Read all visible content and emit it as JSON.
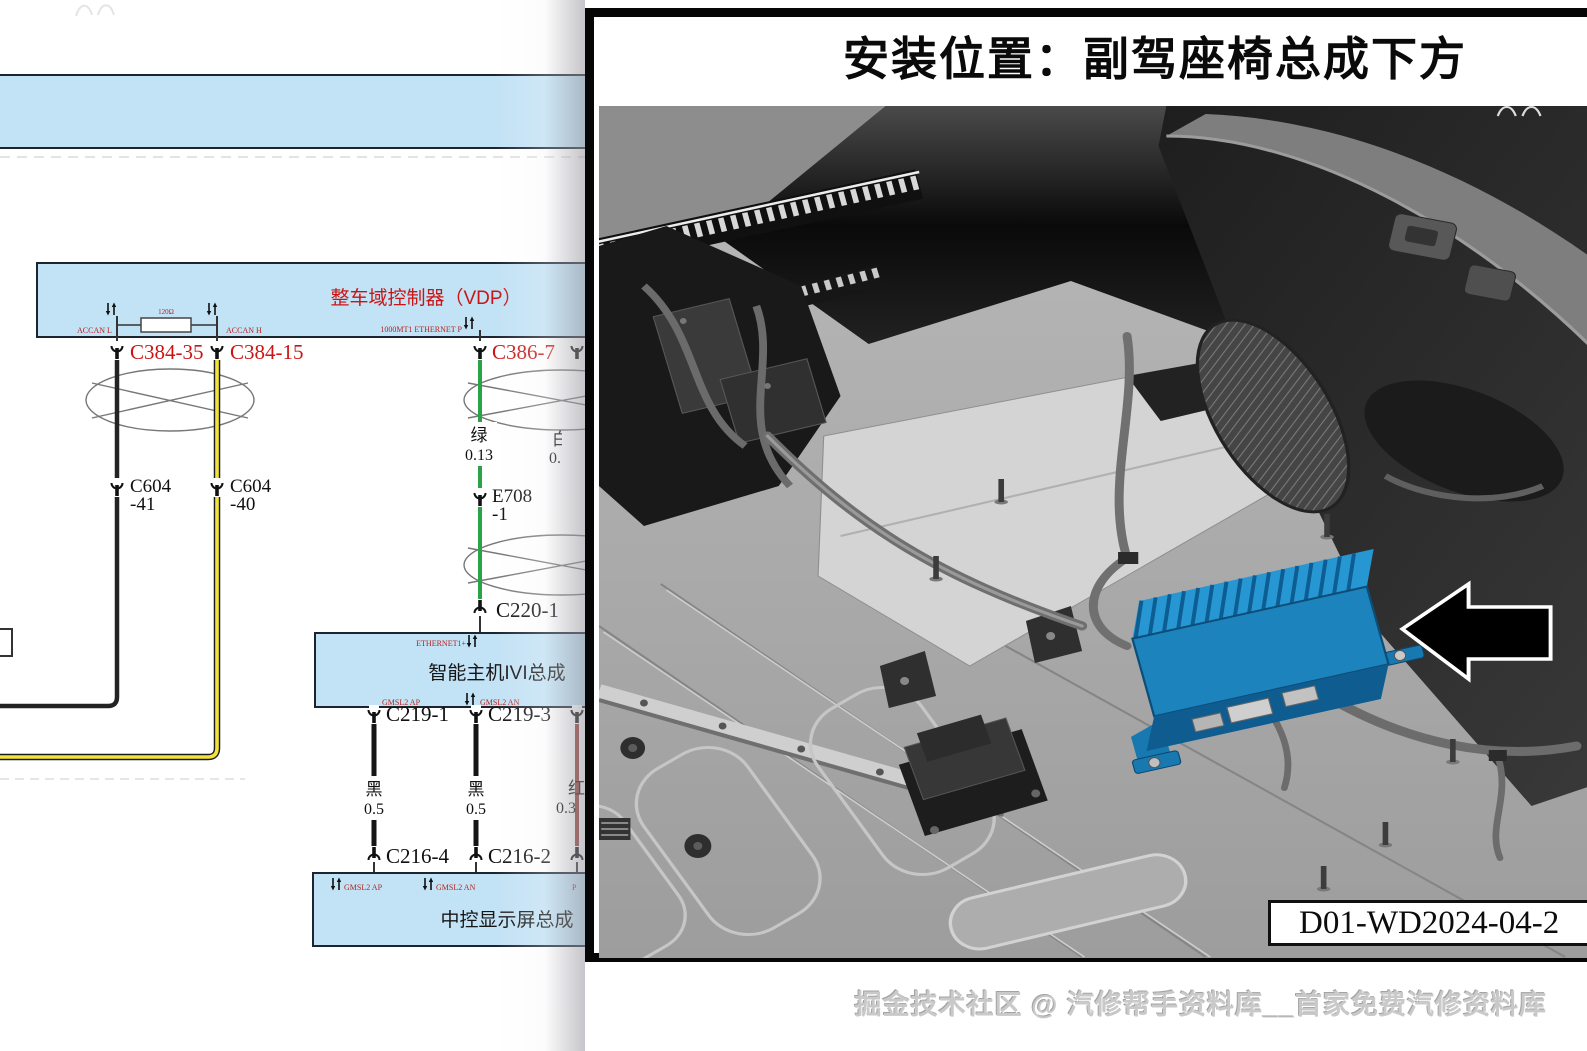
{
  "colors": {
    "box_fill": "#c2e2f5",
    "box_border": "#1c2430",
    "label_red": "#cc1414",
    "wire_black": "#232323",
    "wire_yellow": "#f2e43c",
    "wire_green": "#2ba14a",
    "wire_red": "#9a3a34",
    "module_blue": "#1d83bd",
    "arrow_black": "#000000"
  },
  "icons": {
    "connector_in": "socket-cup-down",
    "connector_out": "socket-cup-up",
    "pin_direction": "up-down-arrows",
    "location_pointer": "left-arrow"
  },
  "diagram": {
    "vdp": {
      "title": "整车域控制器（VDP）",
      "pin_accan_l": "ACCAN L",
      "pin_accan_h": "ACCAN H",
      "resistor": "120Ω",
      "pin_ethernet": "1000MT1 ETHERNET P"
    },
    "ivi": {
      "title": "智能主机IVI总成",
      "pin_ethernet": "ETHERNET1+",
      "pin_ap": "GMSL2 AP",
      "pin_an": "GMSL2 AN"
    },
    "display": {
      "title": "中控显示屏总成",
      "pin_ap": "GMSL2 AP",
      "pin_an": "GMSL2 AN",
      "pin_partial": "P"
    },
    "connectors": {
      "c384_35": "C384-35",
      "c384_15": "C384-15",
      "c386_7": "C386-7",
      "c604_41a": "C604",
      "c604_41b": "-41",
      "c604_40a": "C604",
      "c604_40b": "-40",
      "e708a": "E708",
      "e708b": "-1",
      "c220_1": "C220-1",
      "c219_1": "C219-1",
      "c219_3": "C219-3",
      "c216_4": "C216-4",
      "c216_2": "C216-2"
    },
    "wires": {
      "green_color": "绿",
      "green_size": "0.13",
      "black_color": "黑",
      "black_size": "0.5",
      "white_color": "白",
      "white_size": "0.",
      "red_color": "红",
      "red_size": "0.3"
    }
  },
  "panel": {
    "title": "安装位置：副驾座椅总成下方",
    "doc_code": "D01-WD2024-04-2"
  },
  "watermark": "掘金技术社区 @ 汽修帮手资料库__首家免费汽修资料库"
}
